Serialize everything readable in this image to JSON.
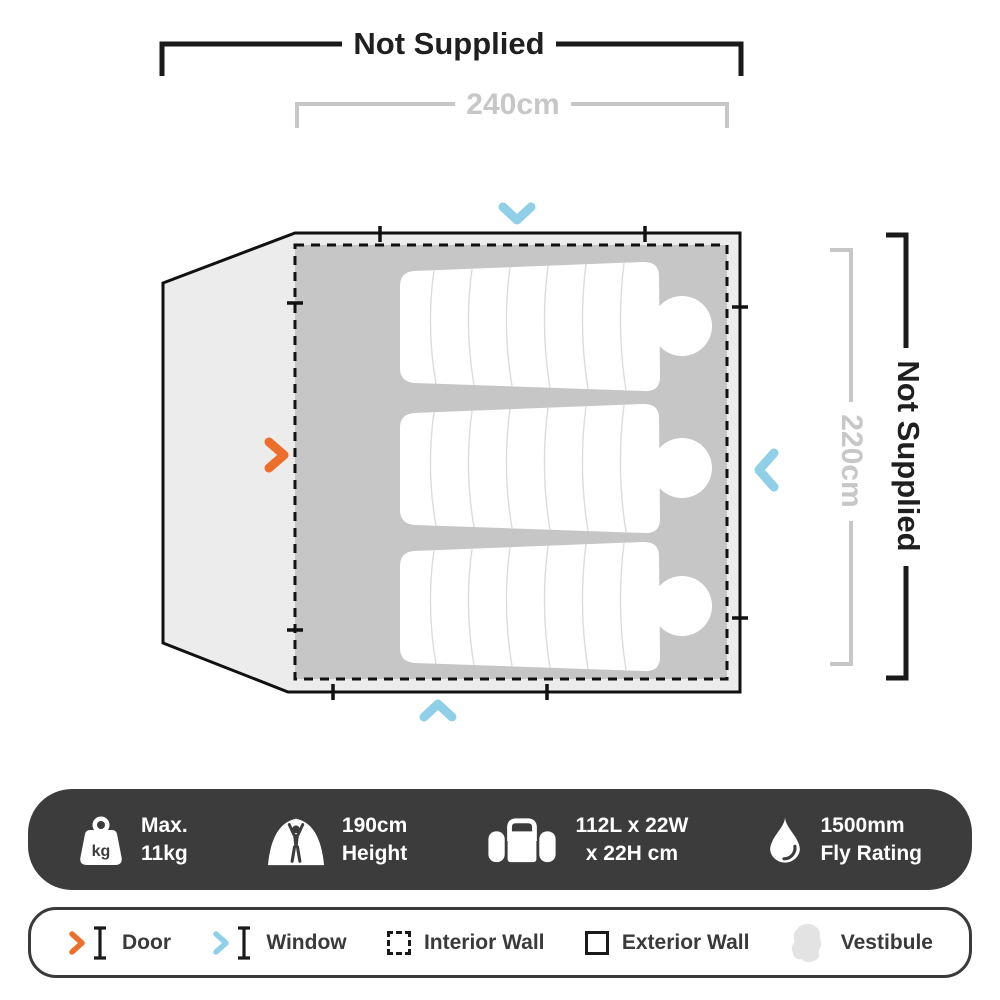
{
  "diagram": {
    "top_not_supplied": "Not Supplied",
    "width_label": "240cm",
    "height_label": "220cm",
    "right_not_supplied": "Not Supplied"
  },
  "specs": {
    "kg_label": "kg",
    "items": [
      {
        "icon": "weight-icon",
        "line1": "Max.",
        "line2": "11kg"
      },
      {
        "icon": "tent-height-icon",
        "line1": "190cm",
        "line2": "Height"
      },
      {
        "icon": "packed-size-icon",
        "line1": "112L x 22W",
        "line2": "x 22H cm"
      },
      {
        "icon": "fly-rating-icon",
        "line1": "1500mm",
        "line2": "Fly Rating"
      }
    ]
  },
  "legend": {
    "items": [
      {
        "label": "Door"
      },
      {
        "label": "Window"
      },
      {
        "label": "Interior Wall"
      },
      {
        "label": "Exterior Wall"
      },
      {
        "label": "Vestibule"
      }
    ]
  },
  "colors": {
    "door": "#ED6E2A",
    "window": "#8FCFE8",
    "interior_fill": "#C6C6C6",
    "vestibule_fill": "#ECECEC",
    "bar_background": "#3C3C3C",
    "dimension_gray": "#C7C7C7",
    "outline_black": "#1A1A1A"
  }
}
